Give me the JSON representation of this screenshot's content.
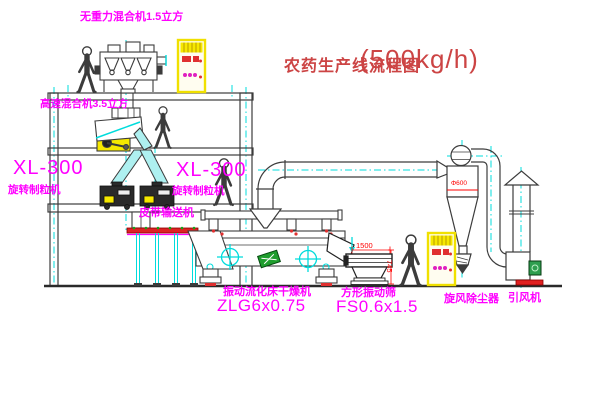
{
  "title": {
    "name": "农药生产线流程图",
    "capacity": "(500kg/h)"
  },
  "equipment": {
    "gravity_mixer": "无重力混合机1.5立方",
    "high_speed_mixer": "高速混合机3.5立方",
    "granulator_left": {
      "model": "XL-300",
      "name": "旋转制粒机"
    },
    "granulator_center": {
      "model": "XL-300",
      "name": "旋转制粒机"
    },
    "belt_conveyor": "皮带输送机",
    "fluid_bed_dryer": {
      "name": "振动流化床干燥机",
      "model": "ZLG6x0.75"
    },
    "square_sieve": {
      "name": "方形振动筛",
      "model": "FS0.6x1.5"
    },
    "cyclone": "旋风除尘器",
    "induced_draft_fan": "引风机"
  },
  "dimensions": {
    "sieve_length": "1500",
    "sieve_height": "745",
    "cyclone_diameter": "Φ600"
  },
  "colors": {
    "label": "#ff00ff",
    "title": "#cc4444",
    "dimension": "#ff0000",
    "centerline": "#00dcdc",
    "cabinet_yellow": "#f6e800",
    "outline": "#3c3c3c",
    "belt_red": "#dd2222",
    "green_plate": "#1f9e2e"
  }
}
